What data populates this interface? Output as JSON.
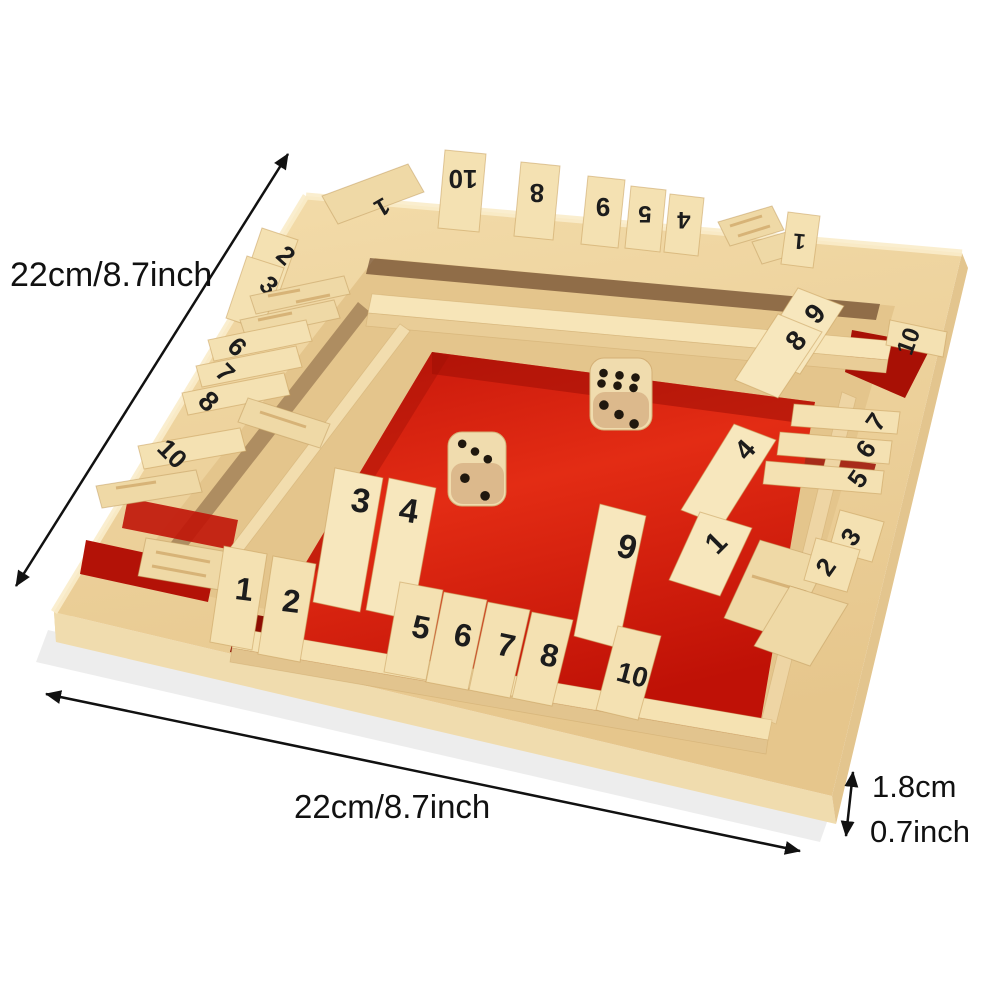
{
  "scene": {
    "description": "Wooden four-sided Shut The Box dice game board with red felt center, number tiles 1-10 on all four sides, two wooden dice, shown tilted on white background with measurement arrows",
    "background": "#ffffff"
  },
  "dimensions": {
    "left_label": "22cm/8.7inch",
    "bottom_label": "22cm/8.7inch",
    "thickness_cm_label": "1.8cm",
    "thickness_inch_label": "0.7inch"
  },
  "board": {
    "colors": {
      "felt_red": "#d8170a",
      "felt_red_dark": "#8e0d03",
      "wood_light": "#f6e4b8",
      "wood_mid": "#edd19c",
      "wood_dark": "#d9b77f",
      "digit_ink": "#1c1c1c",
      "arrow_black": "#111111"
    },
    "tiles": {
      "top": [
        "1",
        "10",
        "8",
        "9",
        "5",
        "4",
        "1"
      ],
      "left": [
        "2",
        "3",
        "6",
        "7",
        "8",
        "10"
      ],
      "right": [
        "9",
        "8",
        "10",
        "7",
        "6",
        "5",
        "4",
        "1",
        "3",
        "2"
      ],
      "bottom": [
        "1",
        "2",
        "3",
        "4",
        "5",
        "6",
        "7",
        "8",
        "9",
        "10"
      ]
    },
    "dice": [
      {
        "top_pips": 3,
        "front_pips": 2
      },
      {
        "top_pips": 6,
        "front_pips": 3
      }
    ]
  }
}
